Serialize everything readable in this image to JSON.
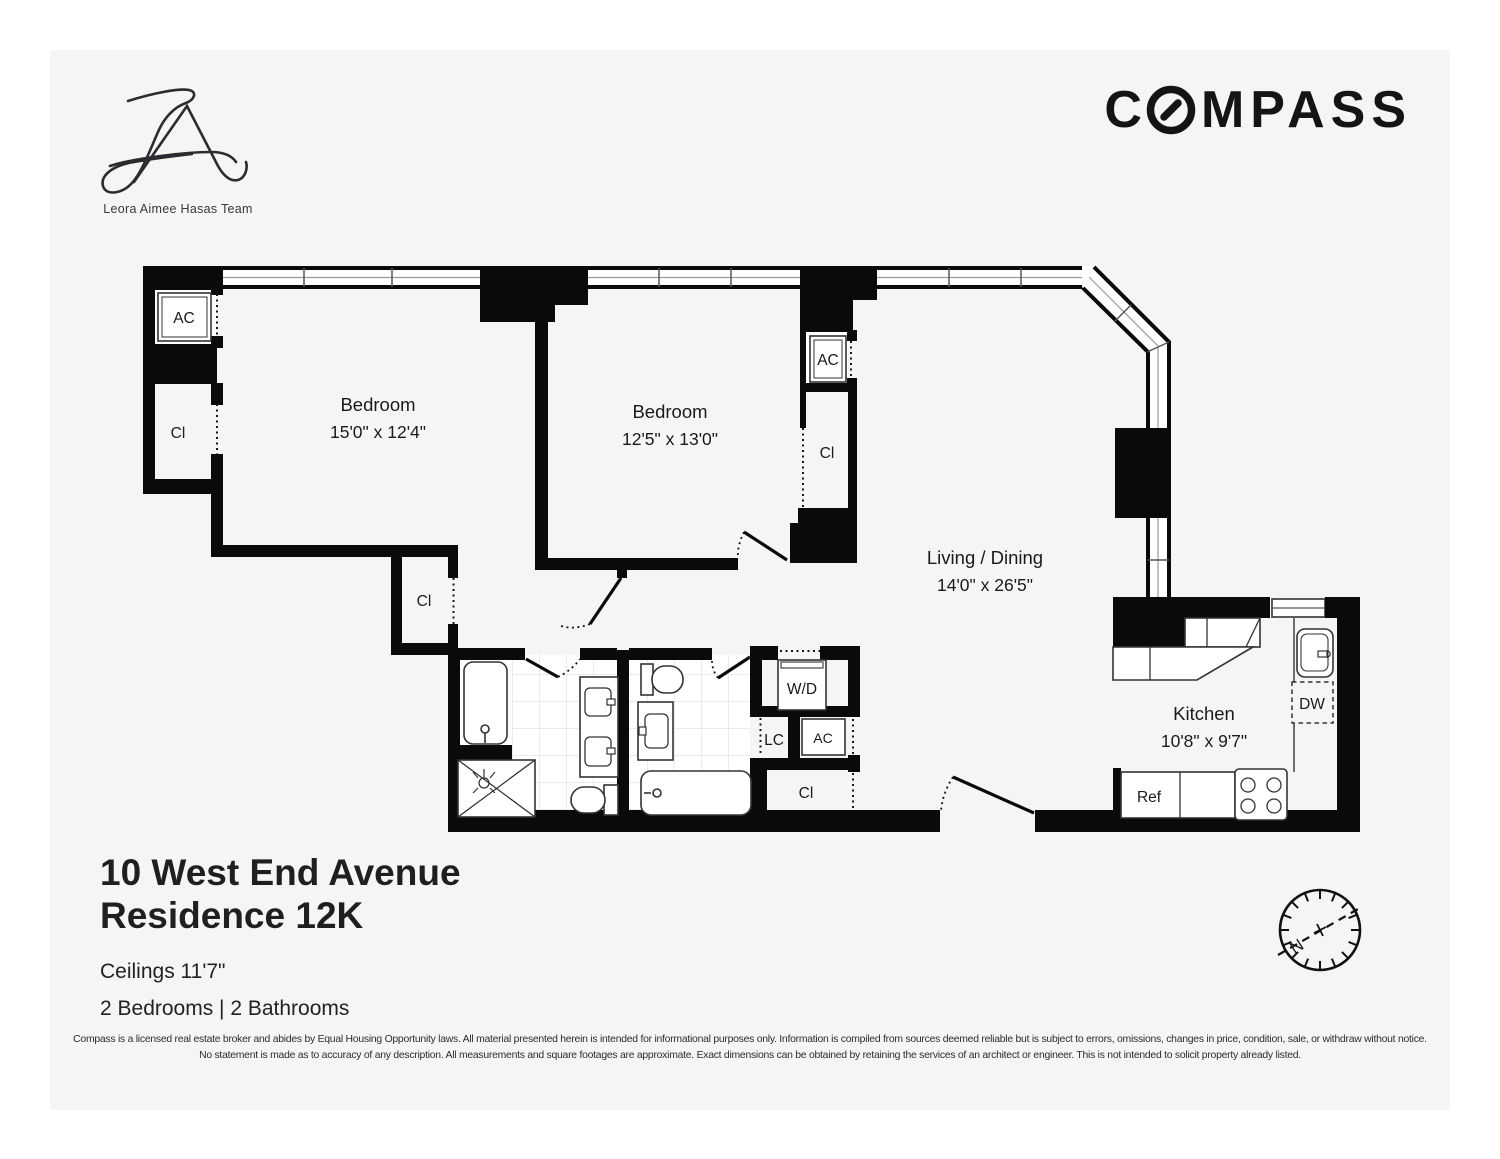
{
  "header": {
    "team_name": "Leora Aimee Hasas Team",
    "brand_c": "C",
    "brand_rest": "MPASS"
  },
  "rooms": {
    "bedroom1": {
      "name": "Bedroom",
      "dims": "15'0\" x 12'4\""
    },
    "bedroom2": {
      "name": "Bedroom",
      "dims": "12'5\" x 13'0\""
    },
    "living": {
      "name": "Living / Dining",
      "dims": "14'0\" x 26'5\""
    },
    "kitchen": {
      "name": "Kitchen",
      "dims": "10'8\" x 9'7\""
    }
  },
  "labels": {
    "ac": "AC",
    "cl": "Cl",
    "lc": "LC",
    "wd": "W/D",
    "dw": "DW",
    "ref": "Ref"
  },
  "compass_rose": {
    "north": "N"
  },
  "title": {
    "line1": "10 West End Avenue",
    "line2": "Residence 12K",
    "ceilings": "Ceilings 11'7\"",
    "beds_baths": "2 Bedrooms | 2 Bathrooms"
  },
  "disclaimer": {
    "line1": "Compass is a licensed real estate broker and abides by Equal Housing Opportunity laws. All material presented herein is intended for informational purposes only. Information is compiled from sources deemed reliable but is subject to errors, omissions, changes in price, condition, sale, or withdraw without notice.",
    "line2": "No statement is made as to accuracy of any description. All measurements and square footages are approximate. Exact dimensions can be obtained by retaining the services of an architect or engineer. This is not intended to solicit property already listed."
  }
}
